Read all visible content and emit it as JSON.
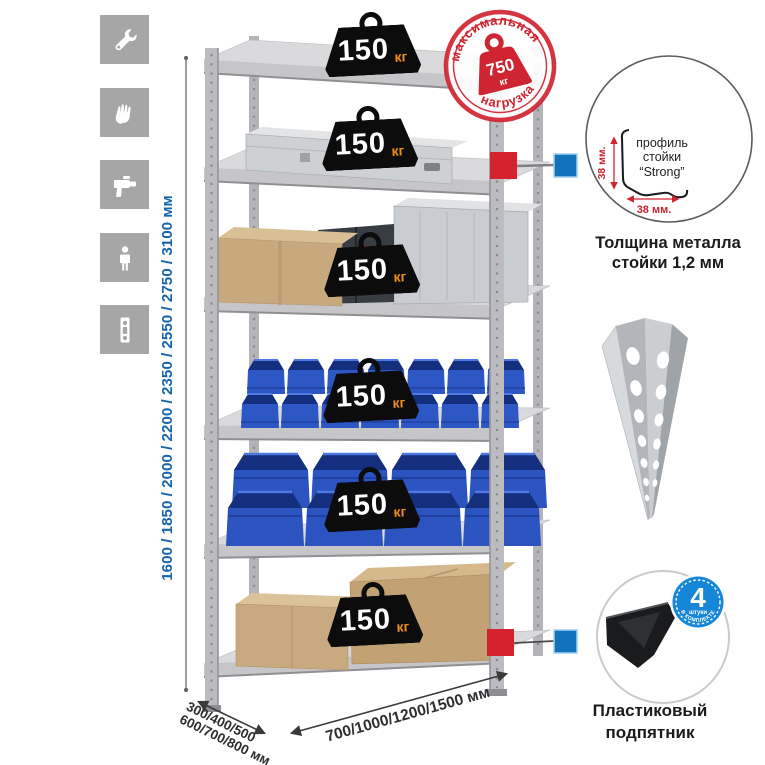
{
  "left_icons": {
    "tile_color": "#a6a6a6",
    "items": [
      "wrench",
      "gloves",
      "drill",
      "person",
      "rack-post"
    ]
  },
  "height_dim": {
    "label": "1600 / 1850 / 2000 / 2200 / 2350 / 2550 / 2750 / 3100 мм",
    "color": "#1565ad"
  },
  "depth_dim": {
    "line1": "300/400/500",
    "line2": "600/700/800 мм"
  },
  "width_dim": {
    "label": "700/1000/1200/1500 мм"
  },
  "max_load_stamp": {
    "arc_top": "максимальная",
    "arc_bottom": "нагрузка",
    "value": "750",
    "unit": "кг",
    "color": "#cf2431"
  },
  "rack": {
    "shelves": [
      {
        "load": "150",
        "unit": "кг"
      },
      {
        "load": "150",
        "unit": "кг"
      },
      {
        "load": "150",
        "unit": "кг"
      },
      {
        "load": "150",
        "unit": "кг"
      },
      {
        "load": "150",
        "unit": "кг"
      },
      {
        "load": "150",
        "unit": "кг"
      }
    ]
  },
  "profile_detail": {
    "label_line1": "профиль",
    "label_line2": "стойки",
    "label_line3": "“Strong”",
    "dim_vertical": "38 мм.",
    "dim_horizontal": "38 мм.",
    "caption_line1": "Толщина металла",
    "caption_line2": "стойки 1,2 мм"
  },
  "foot_detail": {
    "badge_value": "4",
    "badge_sub": "штуки",
    "badge_arc": "в комплекте",
    "caption_line1": "Пластиковый",
    "caption_line2": "подпятник"
  },
  "colors": {
    "accent_red": "#cf2431",
    "accent_blue": "#1272bb",
    "dim_text_blue": "#1565ad",
    "badge_bg": "#0c0c0d",
    "badge_unit_orange": "#f28c1c",
    "icon_tile_gray": "#a6a6a6",
    "metal_light": "#d8d8db",
    "bin_blue": "#2b54c0"
  }
}
